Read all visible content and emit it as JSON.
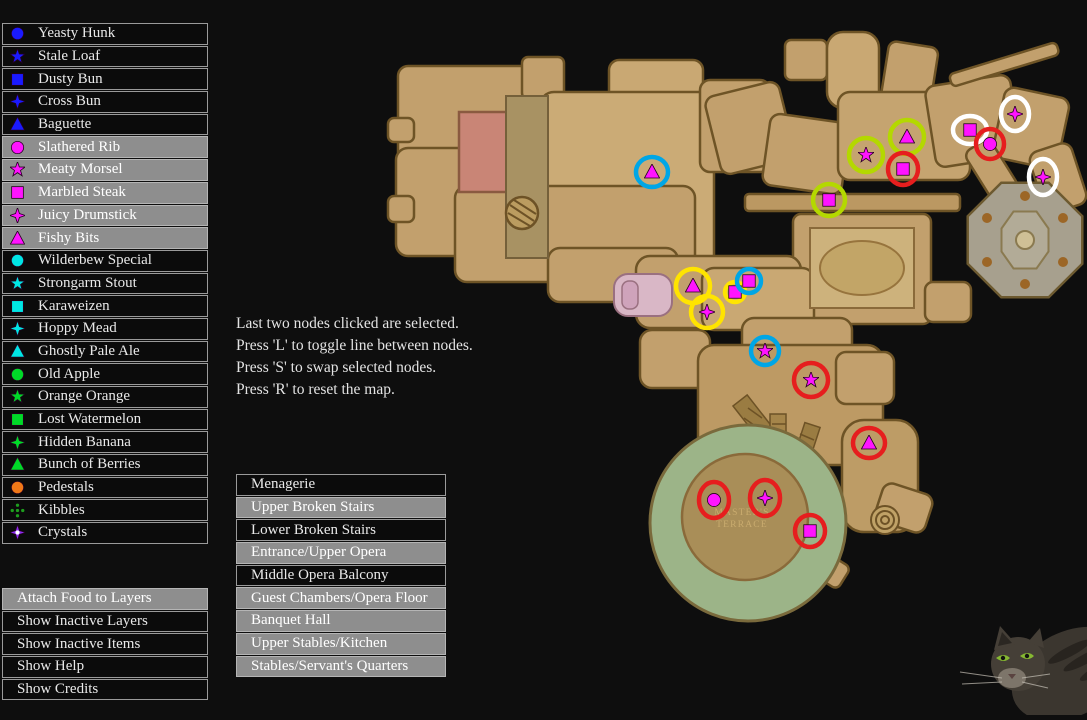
{
  "sidebar_food": {
    "items": [
      {
        "label": "Yeasty Hunk",
        "icon": "circle",
        "color": "#1a1aff",
        "selected": false
      },
      {
        "label": "Stale Loaf",
        "icon": "star",
        "color": "#1a1aff",
        "selected": false
      },
      {
        "label": "Dusty Bun",
        "icon": "square",
        "color": "#1a1aff",
        "selected": false
      },
      {
        "label": "Cross Bun",
        "icon": "cross",
        "color": "#1a1aff",
        "selected": false
      },
      {
        "label": "Baguette",
        "icon": "triangle",
        "color": "#1a1aff",
        "selected": false
      },
      {
        "label": "Slathered Rib",
        "icon": "circle",
        "color": "#ff14ff",
        "selected": true
      },
      {
        "label": "Meaty Morsel",
        "icon": "star",
        "color": "#ff14ff",
        "selected": true
      },
      {
        "label": "Marbled Steak",
        "icon": "square",
        "color": "#ff14ff",
        "selected": true
      },
      {
        "label": "Juicy Drumstick",
        "icon": "cross",
        "color": "#ff14ff",
        "selected": true
      },
      {
        "label": "Fishy Bits",
        "icon": "triangle",
        "color": "#ff14ff",
        "selected": true
      },
      {
        "label": "Wilderbew Special",
        "icon": "circle",
        "color": "#00e5e5",
        "selected": false
      },
      {
        "label": "Strongarm Stout",
        "icon": "star",
        "color": "#00e5e5",
        "selected": false
      },
      {
        "label": "Karaweizen",
        "icon": "square",
        "color": "#00e5e5",
        "selected": false
      },
      {
        "label": "Hoppy Mead",
        "icon": "cross",
        "color": "#00e5e5",
        "selected": false
      },
      {
        "label": "Ghostly Pale Ale",
        "icon": "triangle",
        "color": "#00e5e5",
        "selected": false
      },
      {
        "label": "Old Apple",
        "icon": "circle",
        "color": "#00d928",
        "selected": false
      },
      {
        "label": "Orange Orange",
        "icon": "star",
        "color": "#00d928",
        "selected": false
      },
      {
        "label": "Lost Watermelon",
        "icon": "square",
        "color": "#00d928",
        "selected": false
      },
      {
        "label": "Hidden Banana",
        "icon": "cross",
        "color": "#00d928",
        "selected": false
      },
      {
        "label": "Bunch of Berries",
        "icon": "triangle",
        "color": "#00d928",
        "selected": false
      },
      {
        "label": "Pedestals",
        "icon": "circle",
        "color": "#f07818",
        "selected": false
      },
      {
        "label": "Kibbles",
        "icon": "dots",
        "color": "#1e9e1e",
        "selected": false
      },
      {
        "label": "Crystals",
        "icon": "sparkle",
        "color": "#8c2cf0",
        "selected": false
      }
    ]
  },
  "actions_menu": {
    "items": [
      {
        "label": "Attach Food to Layers",
        "selected": true
      },
      {
        "label": "Show Inactive Layers",
        "selected": false
      },
      {
        "label": "Show Inactive Items",
        "selected": false
      },
      {
        "label": "Show Help",
        "selected": false
      },
      {
        "label": "Show Credits",
        "selected": false
      }
    ]
  },
  "instructions": {
    "lines": [
      "Last two nodes clicked are selected.",
      "Press 'L' to toggle line between nodes.",
      "Press 'S' to swap selected nodes.",
      "Press 'R' to reset the map."
    ]
  },
  "layers_menu": {
    "items": [
      {
        "label": "Menagerie",
        "active": false
      },
      {
        "label": "Upper Broken Stairs",
        "active": true
      },
      {
        "label": "Lower Broken Stairs",
        "active": false
      },
      {
        "label": "Entrance/Upper Opera",
        "active": true
      },
      {
        "label": "Middle Opera Balcony",
        "active": false
      },
      {
        "label": "Guest Chambers/Opera Floor",
        "active": true
      },
      {
        "label": "Banquet Hall",
        "active": true
      },
      {
        "label": "Upper Stables/Kitchen",
        "active": true
      },
      {
        "label": "Stables/Servant's Quarters",
        "active": true
      }
    ]
  },
  "map": {
    "terrace_label": [
      "MASTER'S",
      "TERRACE"
    ],
    "marker_color": "#ff14ff",
    "ring_colors": {
      "white": "#ffffff",
      "red": "#e61e1e",
      "yellow": "#ffe400",
      "chartreuse": "#b4d800",
      "cyan": "#00a6e6"
    },
    "markers": [
      {
        "x": 652,
        "y": 172,
        "shape": "triangle",
        "ring": "cyan",
        "rx": 16,
        "ry": 15
      },
      {
        "x": 866,
        "y": 155,
        "shape": "star",
        "ring": "chartreuse",
        "rx": 17,
        "ry": 17
      },
      {
        "x": 907,
        "y": 137,
        "shape": "triangle",
        "ring": "chartreuse",
        "rx": 17,
        "ry": 17
      },
      {
        "x": 903,
        "y": 169,
        "shape": "square",
        "ring": "red",
        "rx": 15,
        "ry": 16
      },
      {
        "x": 829,
        "y": 200,
        "shape": "square",
        "ring": "chartreuse",
        "rx": 16,
        "ry": 16
      },
      {
        "x": 970,
        "y": 130,
        "shape": "square",
        "ring": "white",
        "rx": 17,
        "ry": 14
      },
      {
        "x": 990,
        "y": 144,
        "shape": "circle",
        "ring": "red",
        "rx": 14,
        "ry": 15
      },
      {
        "x": 1015,
        "y": 114,
        "shape": "cross",
        "ring": "white",
        "rx": 14,
        "ry": 17
      },
      {
        "x": 1043,
        "y": 177,
        "shape": "cross",
        "ring": "white",
        "rx": 14,
        "ry": 18
      },
      {
        "x": 693,
        "y": 286,
        "shape": "triangle",
        "ring": "yellow",
        "rx": 17,
        "ry": 17
      },
      {
        "x": 707,
        "y": 312,
        "shape": "cross",
        "ring": "yellow",
        "rx": 16,
        "ry": 16
      },
      {
        "x": 735,
        "y": 292,
        "shape": "square",
        "ring": "yellow",
        "rx": 10,
        "ry": 10
      },
      {
        "x": 749,
        "y": 281,
        "shape": "square",
        "ring": "cyan",
        "rx": 12,
        "ry": 12
      },
      {
        "x": 765,
        "y": 351,
        "shape": "star",
        "ring": "cyan",
        "rx": 14,
        "ry": 14
      },
      {
        "x": 811,
        "y": 380,
        "shape": "star",
        "ring": "red",
        "rx": 17,
        "ry": 17
      },
      {
        "x": 869,
        "y": 443,
        "shape": "triangle",
        "ring": "red",
        "rx": 16,
        "ry": 15
      },
      {
        "x": 714,
        "y": 500,
        "shape": "circle",
        "ring": "red",
        "rx": 15,
        "ry": 18
      },
      {
        "x": 765,
        "y": 498,
        "shape": "cross",
        "ring": "red",
        "rx": 15,
        "ry": 18
      },
      {
        "x": 810,
        "y": 531,
        "shape": "square",
        "ring": "red",
        "rx": 15,
        "ry": 16
      }
    ]
  }
}
